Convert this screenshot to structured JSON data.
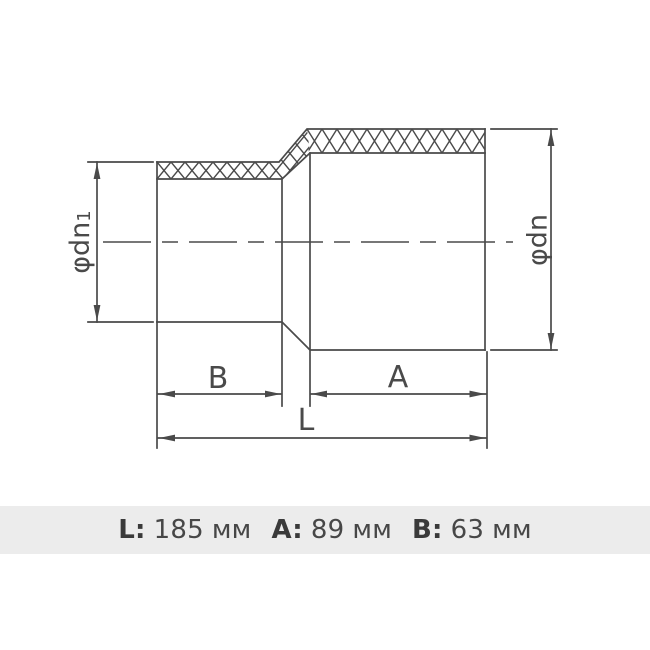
{
  "drawing": {
    "stroke_color": "#4a4a4a",
    "labels": {
      "dia_left": "φdn",
      "dia_left_sub": "1",
      "dia_right": "φdn",
      "dim_b": "B",
      "dim_a": "A",
      "dim_l": "L"
    }
  },
  "caption": {
    "background": "#ececec",
    "items": [
      {
        "label": "L:",
        "value": "185",
        "unit": "мм"
      },
      {
        "label": "A:",
        "value": "89",
        "unit": "мм"
      },
      {
        "label": "B:",
        "value": "63",
        "unit": "мм"
      }
    ]
  }
}
